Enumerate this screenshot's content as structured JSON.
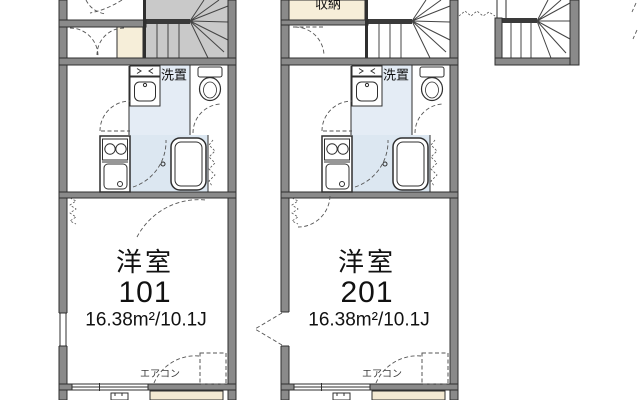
{
  "colors": {
    "wall_fill": "#8a8a8a",
    "wall_stroke": "#2f2f2f",
    "line": "#2f2f2f",
    "stair_fill_101": "#c9c9c9",
    "stair_fill_201": "#ffffff",
    "closet_fill": "#f6eed9",
    "bath_fill": "#dce7f1",
    "washroom_fill": "#e4ecf5",
    "balcony_fill": "#f3e9d2",
    "dash_color": "#555555",
    "text_color": "#111111",
    "aircon_text_color": "#3d3d3d"
  },
  "units": [
    {
      "room_label": "洋室",
      "room_number": "101",
      "area": "16.38m²/10.1J",
      "washer_label": "洗置",
      "aircon_label": "エアコン"
    },
    {
      "room_label": "洋室",
      "room_number": "201",
      "area": "16.38m²/10.1J",
      "washer_label": "洗置",
      "aircon_label": "エアコン",
      "closet_label": "収納"
    }
  ]
}
